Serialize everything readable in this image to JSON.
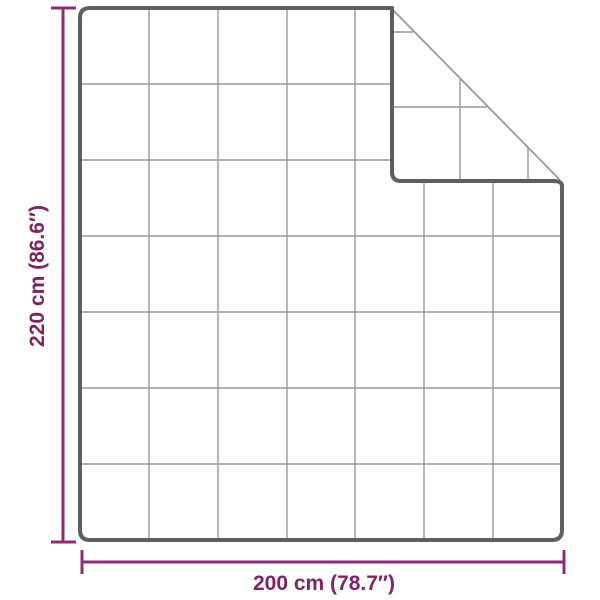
{
  "labels": {
    "height": "220 cm (86.6″)",
    "width": "200 cm (78.7″)"
  },
  "style": {
    "dimension_text_color": "#7E2465",
    "dimension_line_color": "#8D2E74",
    "outline_color": "#5F5F5F",
    "seam_color": "#999999",
    "crease_color": "#9A9A9A",
    "background": "#FFFFFF"
  },
  "blanket": {
    "description": "quilted blanket outline with folded top-right corner",
    "grid_columns": 7,
    "grid_rows": 7,
    "folded_corner": "top-right"
  }
}
